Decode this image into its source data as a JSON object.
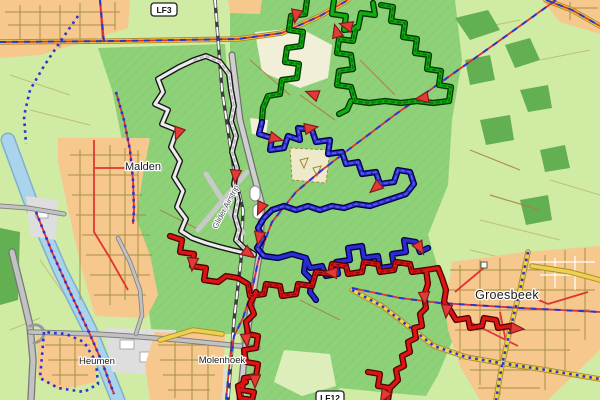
{
  "map": {
    "badges": {
      "lf3": "LF3",
      "lf12": "LF12"
    },
    "towns": {
      "malden": "Malden",
      "groesbeek": "Groesbeek",
      "heumen": "Heumen",
      "molenhoek": "Molenhoek"
    },
    "poi": {
      "airstrip_label": "Glider Airstrip"
    },
    "route_colors": {
      "green": "#12ad12",
      "blue": "#2b2bcf",
      "red": "#dc1414",
      "white": "#ececec"
    },
    "terrain_colors": {
      "fields": "#cfeba4",
      "forest": "#8fd179",
      "forest_dark": "#63b053",
      "town": "#f6c88e",
      "grey_area": "#dedede",
      "water": "#a9d4eb",
      "road_yellow": "#ecd153",
      "road_grey": "#c2c2c2",
      "lf_red": "#e03030",
      "lf_blue": "#2a35d4",
      "arrow_red": "#e53935"
    }
  }
}
